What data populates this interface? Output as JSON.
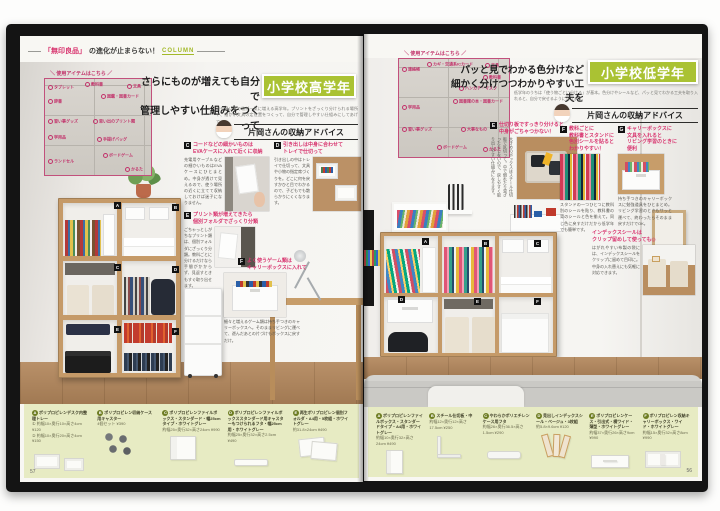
{
  "header": {
    "brand": "「無印良品」",
    "title": "の進化が止まらない！",
    "column": "COLUMN"
  },
  "left": {
    "page_number": "57",
    "diagram_caption": "＼ 使用アイテムはこちら ／",
    "diagram_labels": [
      "タブレット",
      "辞書",
      "教科書",
      "図鑑・図書カード",
      "文具",
      "習い事グッズ",
      "学用品",
      "思い出のプリント類",
      "ランドセル",
      "手提げバッグ",
      "ボードゲーム",
      "かるた"
    ],
    "headline": [
      "さらにものが増えても自分で",
      "管理しやすい仕組みをつくって"
    ],
    "badge": "小学校高学年",
    "lead": "塾や習い事で物が一気に増える高学年。プリントをざっくり分けられる場所や、細かい文具の定位置をつくって、自分で管理しやすい仕組みにしてあげて。",
    "advisor": "片岡さんの収納アドバイス",
    "tips": [
      {
        "mark": "C",
        "l1": "コードなどの細かいものは",
        "l2": "EVAケースに入れて近くに収納",
        "body": "充電用ケーブルなどの細かいものはEVAケースにひとまとめ。中身が透けて見えるので、使う場所の近くに立てて収納しておけば迷子になりません。"
      },
      {
        "mark": "D",
        "l1": "引き出しは中身に合わせて",
        "l2": "トレイで仕切って",
        "body": "引き出しの中はトレイで仕切って、文具や小物の指定席づくりを。どこに何を戻すかひと目でわかるので、子どもでも散らかりにくくなります。"
      },
      {
        "mark": "E",
        "l1": "プリント類が増えてきたら",
        "l2": "個別フォルダでざっくり分類",
        "body": "ごちゃっとしがちなプリント類は、個別フォルダにざっくり分類。教科ごとに分けるだけなら手間がかからず、見返すときもすぐ取り出せます。"
      },
      {
        "mark": "F",
        "l1": "よく使うゲーム類は",
        "l2": "キャリーボックスに入れて",
        "body": "細々と増えるゲーム類は持ち手つきのキャリーボックスへ。そのままリビングに運べて、遊んだあとの片づけもボックスに戻すだけ。"
      }
    ],
    "photo_marks": [
      "A",
      "B",
      "C",
      "D",
      "E",
      "F"
    ],
    "products": [
      {
        "mark": "A",
        "name": "ポリプロピレンデスク内整理トレー",
        "spec1": "① 約幅10×奥行10×高さ4cm ¥120",
        "spec2": "② 約幅10×奥行20×高さ4cm ¥150"
      },
      {
        "mark": "B",
        "name": "ポリプロピレン収納ケース用キャスター",
        "spec1": "4個セット ¥390",
        "spec2": ""
      },
      {
        "mark": "C",
        "name": "ポリプロピレンファイルボックス・スタンダード・幅25cmタイプ・ホワイトグレー",
        "spec1": "約幅25×奥行32×高さ24cm ¥990",
        "spec2": ""
      },
      {
        "mark": "D",
        "name": "ポリプロピレンファイルボックススタンダード用キャスターもつけられるフタ・幅25cm用・ホワイトグレー",
        "spec1": "約幅25×奥行32×高さ2.5cm ¥490",
        "spec2": ""
      },
      {
        "mark": "E",
        "name": "再生ポリプロピレン個別フォルダ・A4用・5枚組・ホワイトグレー",
        "spec1": "約31.8×24cm ¥490",
        "spec2": ""
      }
    ]
  },
  "right": {
    "page_number": "56",
    "diagram_caption": "＼ 使用アイテムはこちら ／",
    "diagram_labels": [
      "連絡帳",
      "カギ・交通系ICカード",
      "文具",
      "教科書",
      "ハンカチ・マスク",
      "図書館の本・図書カード",
      "学用品",
      "習い事グッズ",
      "ボードゲーム",
      "かるた",
      "大事なもの"
    ],
    "headline": [
      "パッと見でわかる色分けなど",
      "細かく分けつつわかりやすい工夫を"
    ],
    "badge": "小学校低学年",
    "lead": "低学年のうちは「使う物ごとに分ける」が基本。色分けやシールなど、パッと見てわかる工夫を取り入れると、自分で戻せるようになります。",
    "advisor": "片岡さんの収納アドバイス",
    "tips": [
      {
        "mark": "E",
        "l1": "仕切り板ですっきり分けると",
        "l2": "中身がごちゃつかない！",
        "l3": "",
        "l4": "",
        "body": "大きめのボックスはスチール仕切板で区切って。中で倒れたり混ざったりしないので、戻しやすく取り出しやすい仕組みになります。"
      },
      {
        "mark": "F",
        "l1": "教科ごとに",
        "l2": "教科書とスタンドに",
        "l3": "色別シールを貼ると",
        "l4": "わかりやすい！",
        "body": "スタンドの一つひとつに教科別のシールを貼り、教科書の背のシールと色を揃えて。同じ色に戻すだけだから低学年でも簡単です。"
      },
      {
        "mark": "G",
        "l1": "キャリーボックスに",
        "l2": "文具を入れると",
        "l3": "リビング学習のときに",
        "l4": "便利",
        "body": "持ち手つきのキャリーボックスに勉強道具をひとまとめ。リビング学習のときもサッと運べて、終わったらそのまま戻すだけでOK。"
      },
      {
        "mark": "",
        "l1": "インデックスシールは",
        "l2": "クリップ留めして使っても◎",
        "l3": "",
        "l4": "",
        "body": "はがれやすい布製の袋には、インデックスシールをクリップに留めて目印に。中身の入れ替えにも気軽に対応できます。"
      }
    ],
    "photo_marks": [
      "A",
      "B",
      "C",
      "D",
      "E",
      "F"
    ],
    "products": [
      {
        "mark": "A",
        "name": "ポリプロピレンファイルボックス・スタンダードタイプ・A4用・ホワイトグレー",
        "spec1": "約幅10×奥行32×高さ24cm ¥490",
        "spec2": ""
      },
      {
        "mark": "B",
        "name": "スチール仕切板・中",
        "spec1": "約幅12×奥行12×高さ17.5cm ¥250",
        "spec2": ""
      },
      {
        "mark": "C",
        "name": "やわらかポリエチレンケース用フタ",
        "spec1": "約幅26×奥行36.5×高さ1.5cm ¥290",
        "spec2": ""
      },
      {
        "mark": "D",
        "name": "見出しインデックスシール・ベージュ・3枚組",
        "spec1": "約5.8×9.6cm ¥120",
        "spec2": ""
      },
      {
        "mark": "E",
        "name": "ポリプロピレンケース・引出式・横ワイド・薄型・ホワイトグレー",
        "spec1": "約幅37×奥行26×高さ9cm ¥990",
        "spec2": ""
      },
      {
        "mark": "F",
        "name": "ポリプロピレン収納キャリーボックス・ワイド・ホワイトグレー",
        "spec1": "約幅15×奥行32×高さ8cm ¥990",
        "spec2": ""
      }
    ]
  }
}
